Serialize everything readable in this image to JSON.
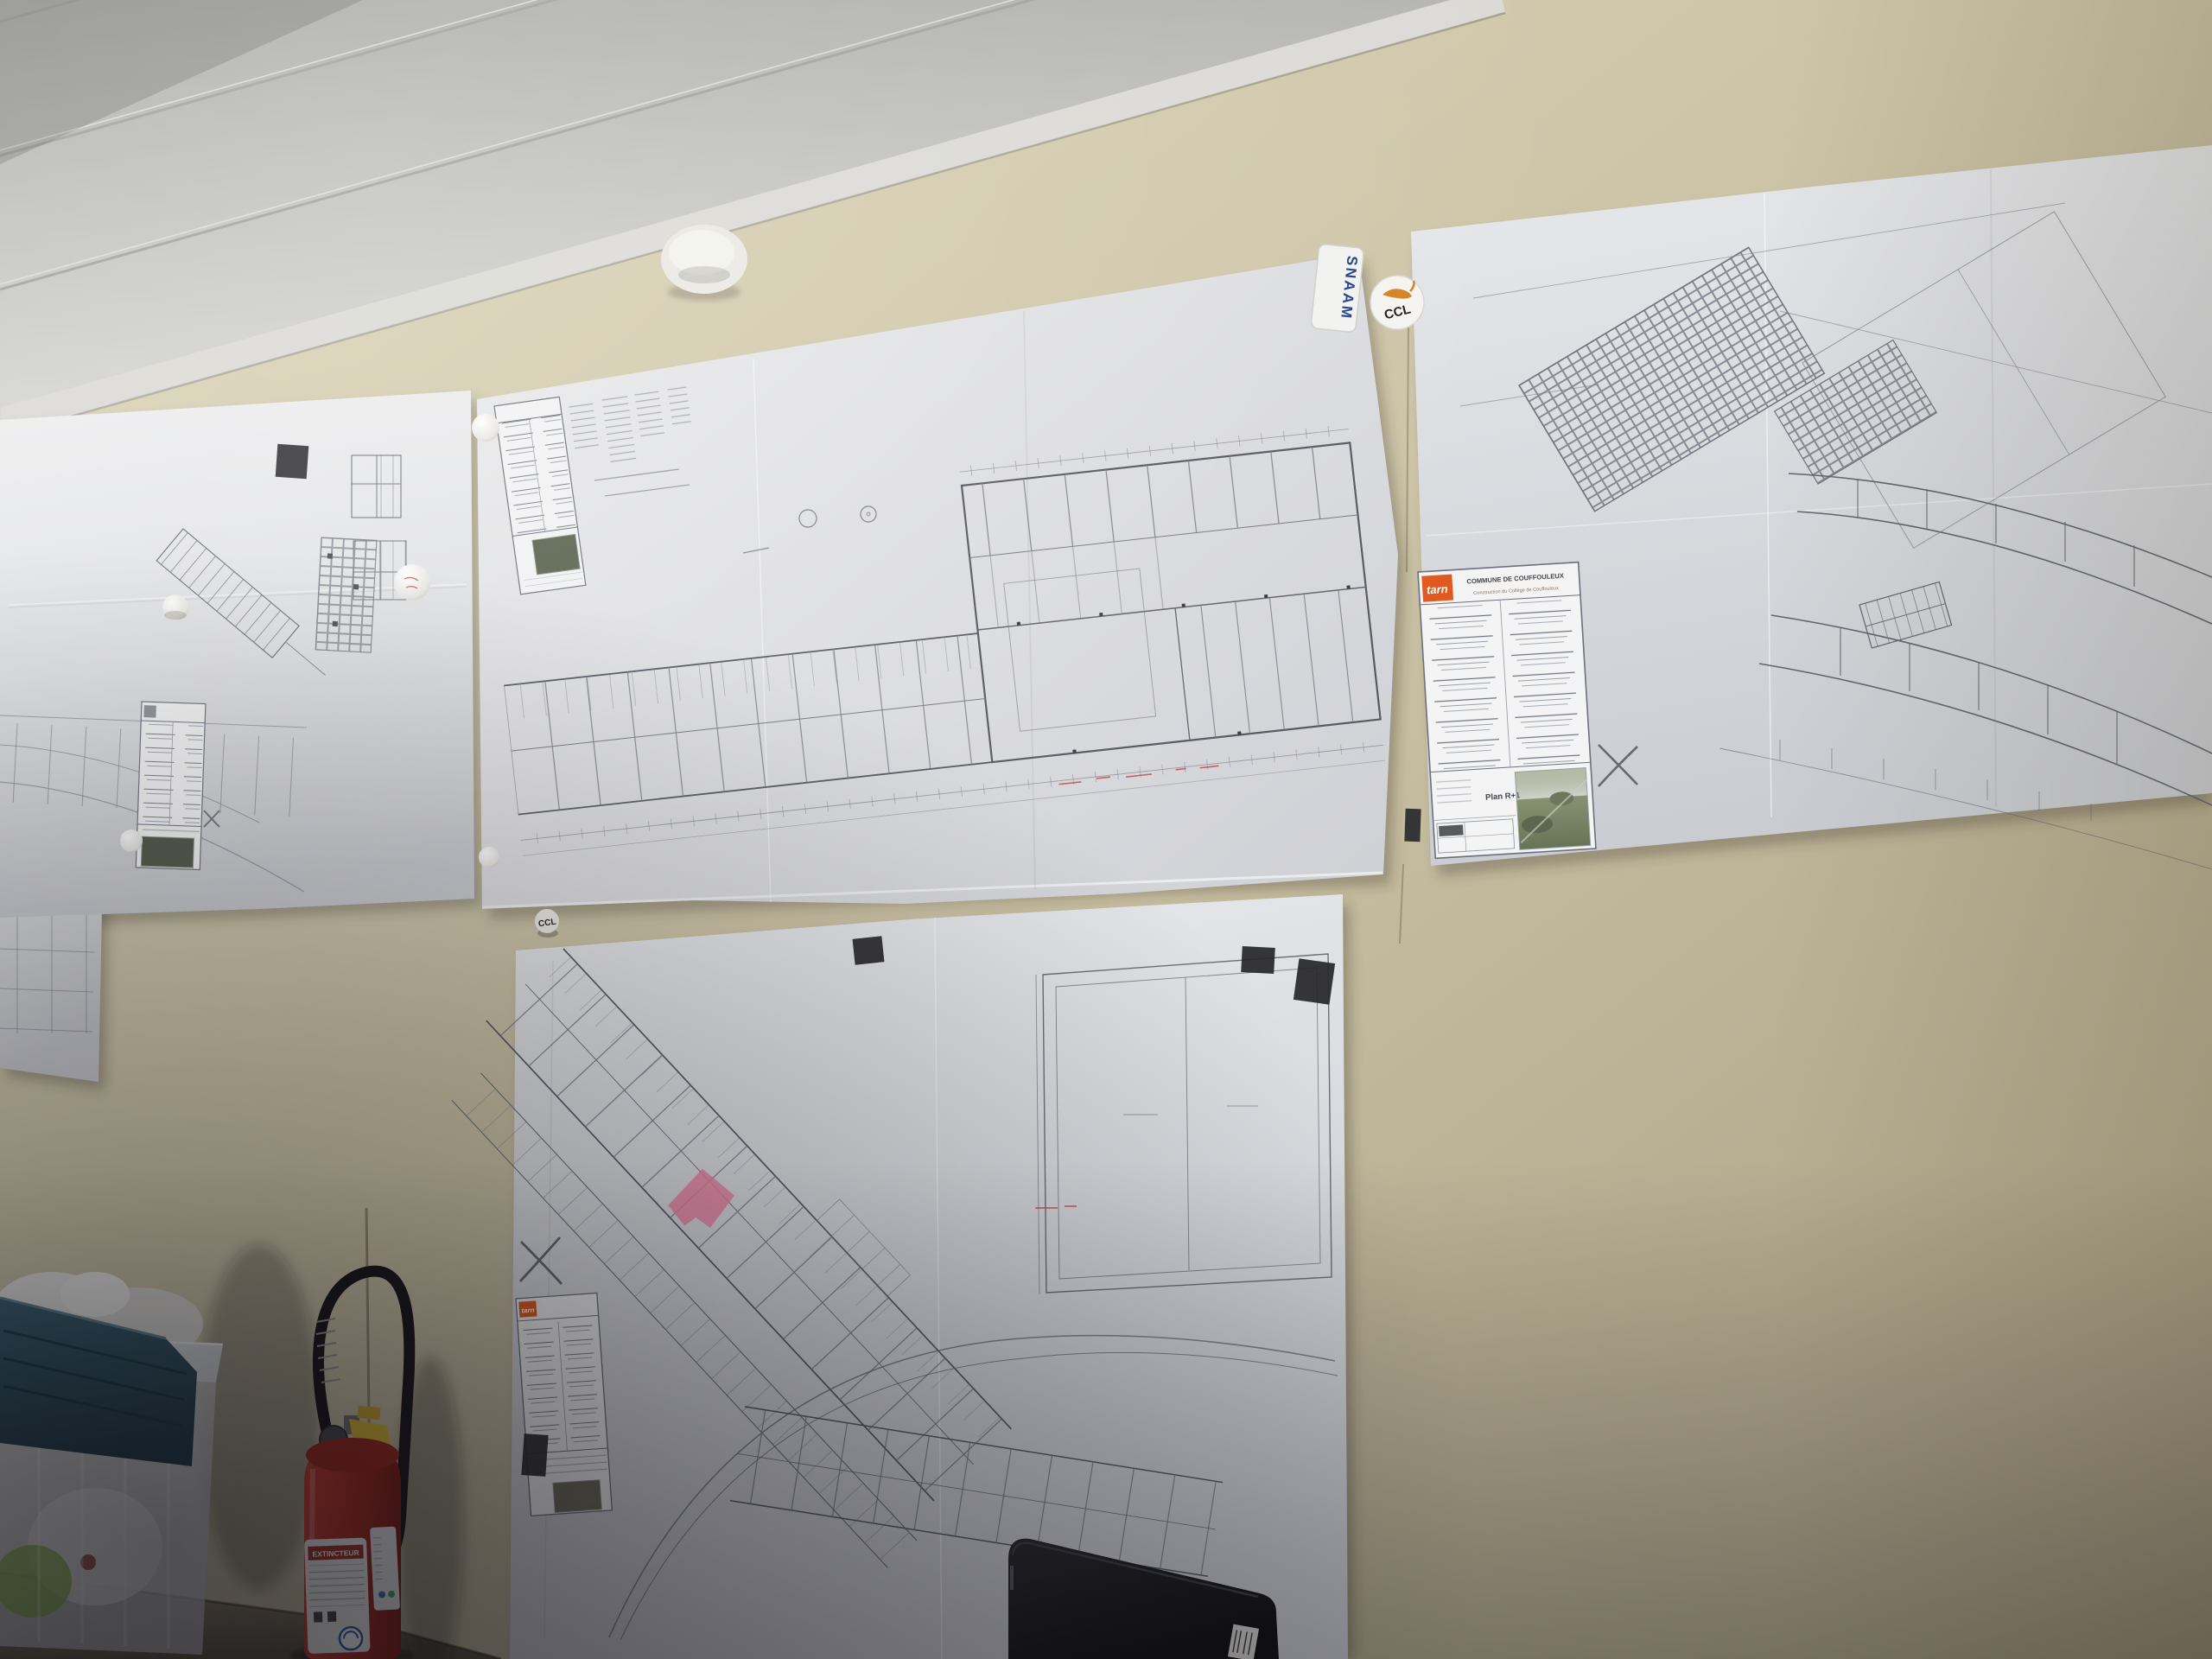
{
  "scene": {
    "description": "Photograph of a construction site office wall covered with taped-up architectural floor plan drawings"
  },
  "titleblock": {
    "logo_label": "tarn",
    "commune": "COMMUNE DE COUFFOULEUX",
    "project": "Construction du Collège de Couffouleux",
    "plan_label": "Plan R+1"
  },
  "stickers": {
    "snaam_label": "SNAAM",
    "ccl_badge_label": "CCL",
    "ccl_magnet_label": "CCL"
  },
  "extinguisher": {
    "label": "EXTINCTEUR"
  },
  "colors": {
    "wall": "#cdc5a7",
    "ceiling": "#c7c7c5",
    "paper": "#e2e3e6",
    "plan_line": "#6f747e",
    "accent_orange": "#e05a20",
    "snaam_blue": "#22418f",
    "ccl_cat_orange": "#d2851f",
    "tape_black": "#26262a",
    "extinguisher_red": "#b02c22",
    "safety_pin_yellow": "#d9b832",
    "lid_teal": "#2c4d5a",
    "highlight_pink": "#ef83a2",
    "floor": "#8a7c64"
  }
}
